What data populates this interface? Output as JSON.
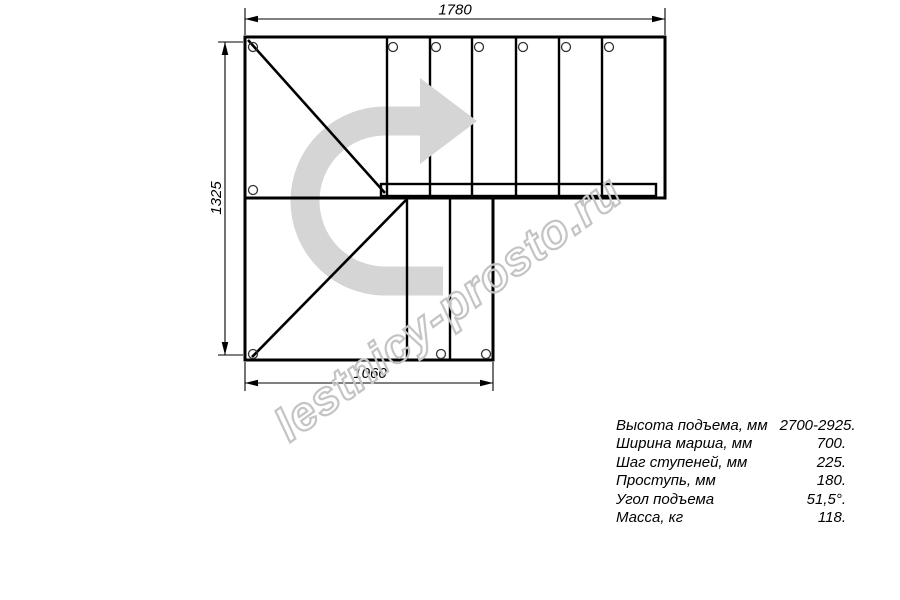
{
  "drawing": {
    "dimensions": {
      "top": "1780",
      "left": "1325",
      "bottom": "1060"
    },
    "colors": {
      "line": "#000000",
      "arrow": "#d5d5d5",
      "watermark_outline": "#c4c4c4"
    }
  },
  "watermark": {
    "text": "lestnicy-prosto.ru"
  },
  "specs": {
    "rows": [
      {
        "label": "Высота подъема, мм",
        "value": "2700-2925."
      },
      {
        "label": "Ширина марша, мм",
        "value": "700."
      },
      {
        "label": "Шаг ступеней, мм",
        "value": "225."
      },
      {
        "label": "Проступь, мм",
        "value": "180."
      },
      {
        "label": "Угол подъема",
        "value": "51,5°."
      },
      {
        "label": "Масса, кг",
        "value": "118."
      }
    ]
  }
}
